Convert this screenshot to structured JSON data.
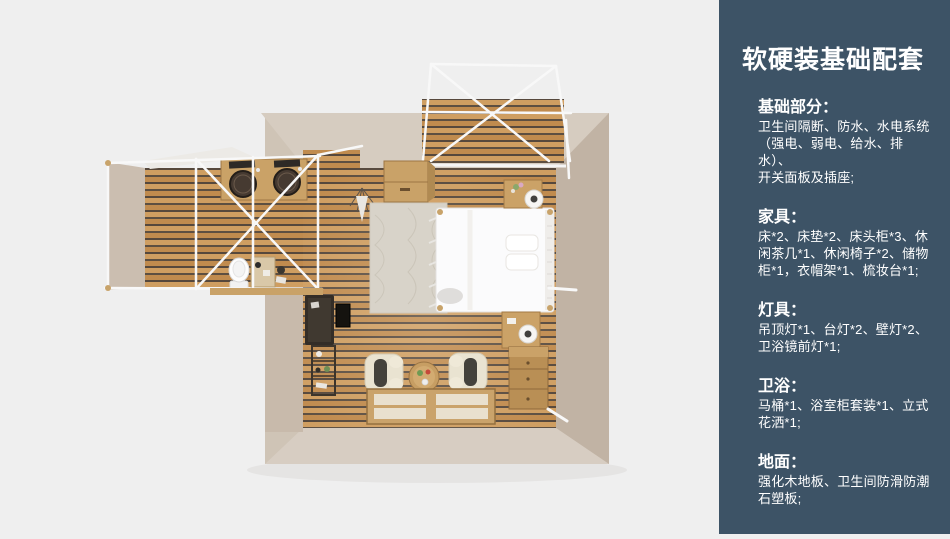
{
  "background_color": "#efefef",
  "panel": {
    "bg_color": "#3d5366",
    "title": "软硬装基础配套",
    "sections": [
      {
        "heading": "基础部分：",
        "lines": [
          "卫生间隔断、防水、水电系统",
          "（强电、弱电、给水、排水）、",
          "开关面板及插座;"
        ]
      },
      {
        "heading": "家具：",
        "lines": [
          "床*2、床垫*2、床头柜*3、休",
          "闲茶几*1、休闲椅子*2、储物",
          "柜*1，衣帽架*1、梳妆台*1;"
        ]
      },
      {
        "heading": "灯具：",
        "lines": [
          "吊顶灯*1、台灯*2、壁灯*2、",
          "卫浴镜前灯*1;"
        ]
      },
      {
        "heading": "卫浴：",
        "lines": [
          "马桶*1、浴室柜套装*1、立式",
          "花洒*1;"
        ]
      },
      {
        "heading": "地面：",
        "lines": [
          "强化木地板、卫生间防滑防潮",
          "石塑板;"
        ]
      }
    ]
  },
  "floorplan": {
    "wood_floor_color": "#c8955a",
    "wood_stripe_color": "#56483c",
    "wall_color": "#d6ccc0",
    "frame_color": "#f8f8f8",
    "rug_color": "#d8d3c9",
    "objects": [
      "porch-canopy-frame",
      "porch-deck",
      "bathroom-annex",
      "vanity-double-sink",
      "toilet",
      "bed",
      "pillows",
      "rug",
      "nightstand-top",
      "nightstand-bottom",
      "table-lamp",
      "dresser",
      "armchair-left",
      "armchair-right",
      "coffee-table",
      "floor-window",
      "desk",
      "tv",
      "shelf-rack",
      "storage-cabinet",
      "hanging-plant"
    ]
  }
}
